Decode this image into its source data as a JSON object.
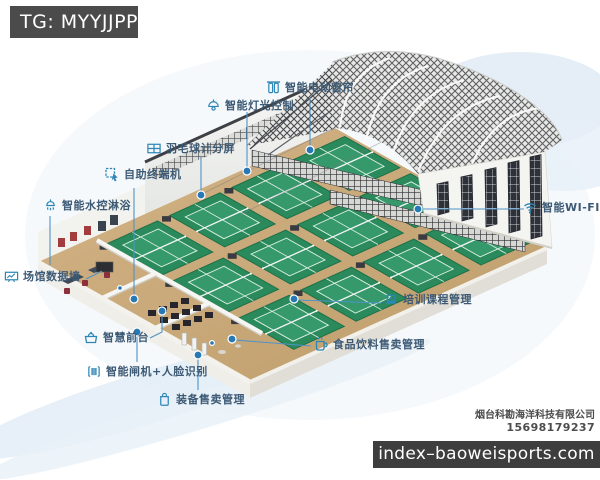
{
  "watermark": {
    "telegram": "TG: MYYJJPP",
    "website": "index–baoweisports.com"
  },
  "vendor": {
    "company": "烟台科勘海洋科技有限公司",
    "phone": "15698179237"
  },
  "scene": {
    "description": "Isometric 3D rendering of a smart badminton hall: arched steel lattice roof on the right, white walls, wooden floor with 12 green badminton courts, reception and entrance area at lower left, blue callout markers connected to smart-facility labels",
    "courts_count": 12,
    "colors": {
      "accent_blue": "#2e86b5",
      "connector_blue": "#4f93c8",
      "label_text": "#3d5a75",
      "court_green": "#2f8e5f",
      "floor_wood": "#c9a877",
      "watermark_bg": "#454545"
    }
  },
  "callouts": [
    {
      "id": "electric-curtain",
      "icon": "curtain-icon",
      "text": "智能电动窗帘"
    },
    {
      "id": "lighting-control",
      "icon": "pendant-lamp-icon",
      "text": "智能灯光控制"
    },
    {
      "id": "badminton-score-screen",
      "icon": "scoreboard-icon",
      "text": "羽毛球计分屏"
    },
    {
      "id": "self-service-terminal",
      "icon": "touch-kiosk-icon",
      "text": "自助终端机"
    },
    {
      "id": "water-controlled-shower",
      "icon": "shower-icon",
      "text": "智能水控淋浴"
    },
    {
      "id": "smart-wifi",
      "icon": "wifi-icon",
      "text": "智能WI-FI"
    },
    {
      "id": "venue-data-wall",
      "icon": "data-screen-icon",
      "text": "场馆数据墙"
    },
    {
      "id": "training-course-management",
      "icon": "laptop-icon",
      "text": "培训课程管理"
    },
    {
      "id": "smart-front-desk",
      "icon": "front-desk-icon",
      "text": "智慧前台"
    },
    {
      "id": "food-beverage-sales",
      "icon": "cup-icon",
      "text": "食品饮料售卖管理"
    },
    {
      "id": "smart-gate-face-recognition",
      "icon": "turnstile-icon",
      "text": "智能闸机+人脸识别"
    },
    {
      "id": "equipment-sales",
      "icon": "shopping-bag-icon",
      "text": "装备售卖管理"
    }
  ]
}
